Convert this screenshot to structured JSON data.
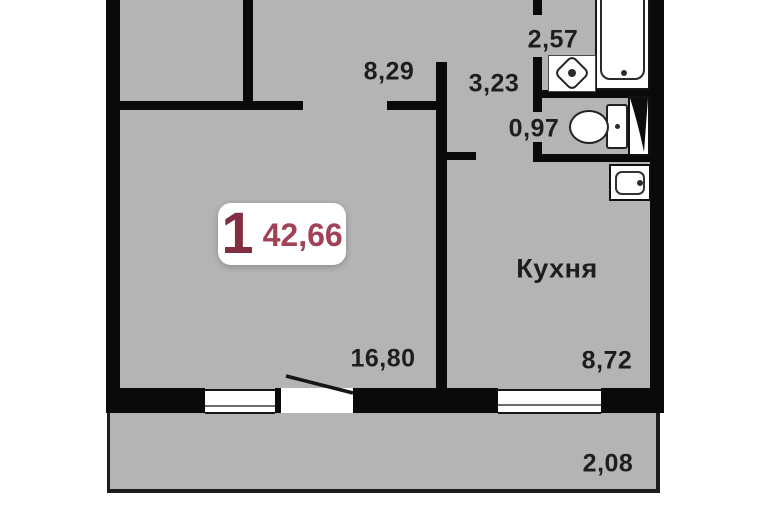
{
  "plan": {
    "badge": {
      "rooms": "1",
      "area": "42,66"
    },
    "labels": {
      "hall": "8,29",
      "bathroom": "2,57",
      "corridor": "3,23",
      "wc": "0,97",
      "kitchen_name": "Кухня",
      "kitchen_area": "8,72",
      "living": "16,80",
      "balcony": "2,08"
    },
    "fixtures": [
      "bathtub-icon",
      "wash-sink-icon",
      "toilet-icon",
      "vent-shaft-icon",
      "kitchen-sink-icon",
      "window-icon",
      "balcony-door-icon"
    ],
    "colors": {
      "floor": "#b4b4b4",
      "wall": "#0a0a0a",
      "badge_rooms_accent": "#812e42",
      "badge_area_accent": "#a24257",
      "label_text": "#1e1e1e"
    }
  }
}
